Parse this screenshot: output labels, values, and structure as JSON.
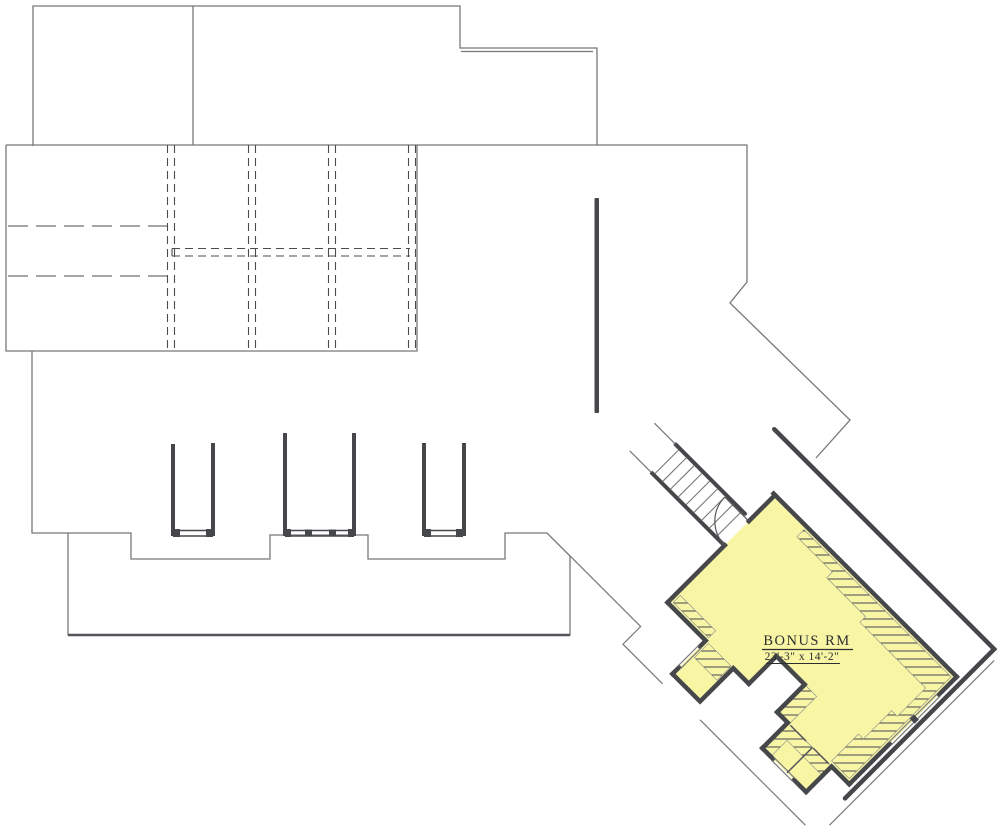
{
  "plan": {
    "type": "floor-plan",
    "room_label": "BONUS RM",
    "room_dimensions": "23'-3\" x 14'-2\""
  },
  "colors": {
    "background": "#ffffff",
    "thin_outline": "#77787b",
    "thick_wall": "#46474a",
    "room_fill": "#f8f5a5",
    "hatch_stroke": "#53545a",
    "text": "#2e2e30"
  },
  "features": {
    "dormer_count": 3,
    "staircase": "diagonal stair run with treads leading to bonus room door",
    "door": "quarter-circle swing arc at bonus room entry",
    "roof_plan": "dashed ridge and framing lines in upper-left block"
  }
}
